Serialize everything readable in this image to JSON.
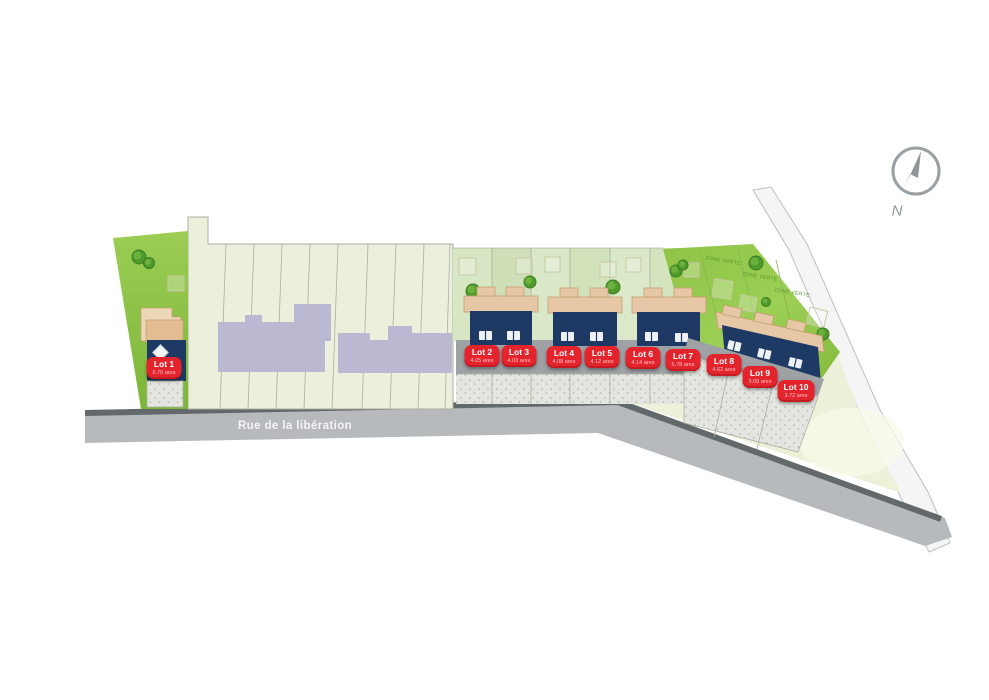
{
  "compass": {
    "label": "N"
  },
  "street": {
    "name": "Rue de la libération"
  },
  "zone_verte": {
    "labels": [
      "ZONE VERTE",
      "ZONE VERTE",
      "ZONE VERTE"
    ]
  },
  "lots": [
    {
      "name": "Lot 1",
      "area": "6.70 ares"
    },
    {
      "name": "Lot 2",
      "area": "4.05 ares"
    },
    {
      "name": "Lot 3",
      "area": "4.03 ares"
    },
    {
      "name": "Lot 4",
      "area": "4.08 ares"
    },
    {
      "name": "Lot 5",
      "area": "4.12 ares"
    },
    {
      "name": "Lot 6",
      "area": "4.14 ares"
    },
    {
      "name": "Lot 7",
      "area": "5.78 ares"
    },
    {
      "name": "Lot 8",
      "area": "4.62 ares"
    },
    {
      "name": "Lot 9",
      "area": "3.09 ares"
    },
    {
      "name": "Lot 10",
      "area": "3.72 ares"
    }
  ],
  "colors": {
    "badge_red": "#e4242d",
    "new_house_navy": "#1e3a64",
    "existing_building_lavender": "#bbb8d1",
    "grass_bright": "#8fc447",
    "grass_pale": "#d7e6c3",
    "field_cream": "#ecefdb",
    "road_gray": "#b6babc",
    "curb_dark": "#63686b",
    "garage_tan": "#e6c8a6",
    "greenway_white": "#f4f5f4"
  }
}
